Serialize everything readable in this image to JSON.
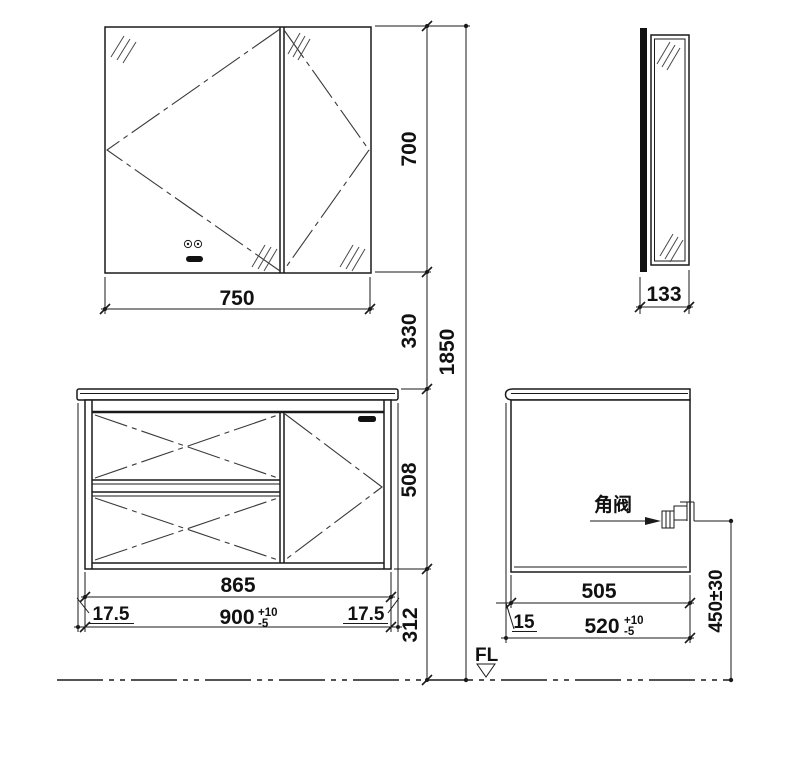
{
  "meta": {
    "drawing_type": "bathroom mirror cabinet and vanity dimensional drawing",
    "line_color": "#1a1a1a",
    "background_color": "#ffffff"
  },
  "labels": {
    "mirror_width": "750",
    "mirror_depth": "133",
    "mirror_height": "700",
    "gap_mirror_to_counter": "330",
    "overall_height": "1850",
    "vanity_height": "508",
    "under_clearance": "312",
    "cabinet_width": "865",
    "counter_width": "900",
    "counter_width_tol_plus": "+10",
    "counter_width_tol_minus": "-5",
    "overhang_left": "17.5",
    "overhang_right": "17.5",
    "cabinet_depth": "505",
    "counter_depth": "520",
    "counter_depth_tol_plus": "+10",
    "counter_depth_tol_minus": "-5",
    "front_overhang": "15",
    "valve": "角阀",
    "valve_height": "450±30",
    "floor": "FL"
  }
}
